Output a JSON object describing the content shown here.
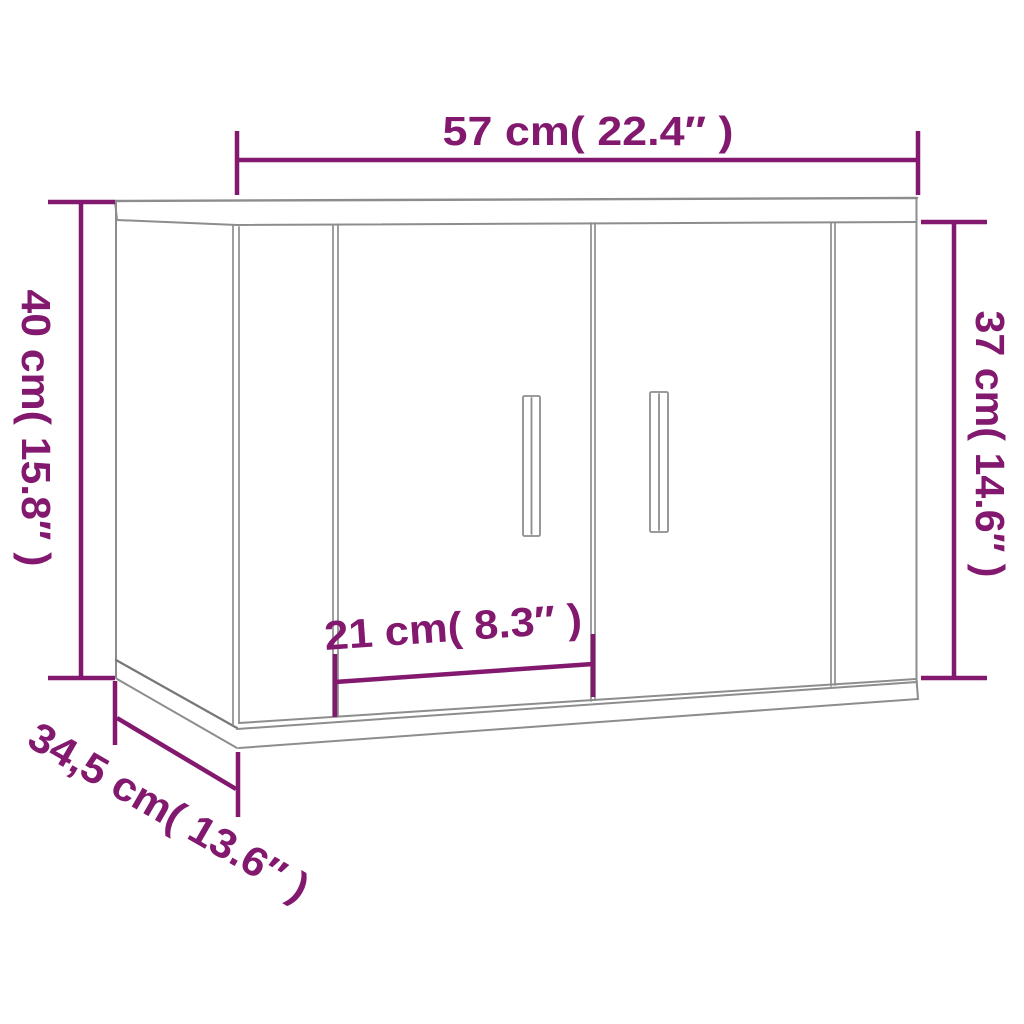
{
  "diagram": {
    "subject": "Wall-mounted cabinet with two doors - dimension drawing",
    "accent_color": "#82196e",
    "line_color": "#8d8d8d",
    "dimensions": {
      "width": {
        "label": "57 cm( 22.4″ )",
        "cm": "57",
        "inches": "22.4"
      },
      "total_height": {
        "label": "40 cm( 15.8″ )",
        "cm": "40",
        "inches": "15.8"
      },
      "front_height": {
        "label": "37 cm( 14.6″ )",
        "cm": "37",
        "inches": "14.6"
      },
      "door_width": {
        "label": "21 cm( 8.3″ )",
        "cm": "21",
        "inches": "8.3"
      },
      "depth": {
        "label": "34,5 cm( 13.6″ )",
        "cm": "34,5",
        "inches": "13.6"
      }
    }
  }
}
